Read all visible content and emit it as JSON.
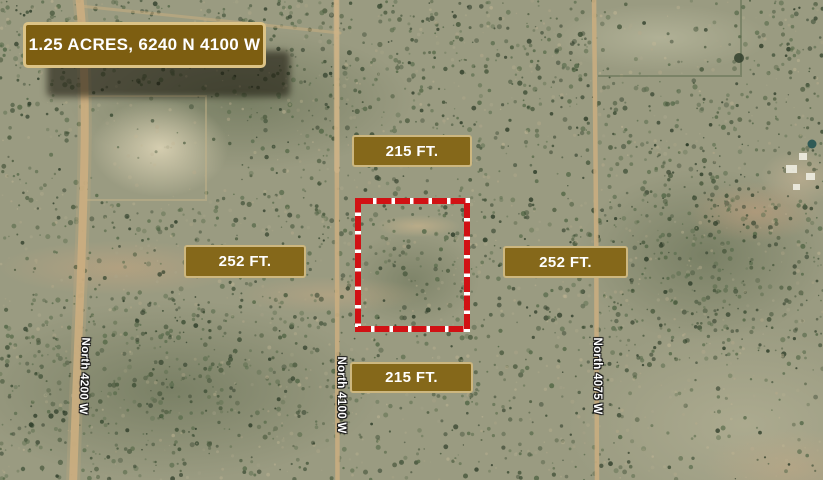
{
  "map": {
    "title_banner": {
      "text": "1.25 ACRES, 6240 N 4100 W"
    },
    "dimension_labels": {
      "top": "215 FT.",
      "bottom": "215 FT.",
      "left": "252 FT.",
      "right": "252 FT."
    },
    "road_labels": [
      {
        "name": "North 4200 W"
      },
      {
        "name": "North 4100 W"
      },
      {
        "name": "North 4075 W"
      }
    ],
    "parcel": {
      "boundary_color": "#d11114",
      "boundary_gap_color": "#ffffff"
    },
    "colors": {
      "banner_background": "#7d5e11",
      "banner_border": "#dcc386",
      "label_background": "#85681a",
      "label_border": "#cdb77f",
      "label_text": "#ffffff"
    }
  }
}
